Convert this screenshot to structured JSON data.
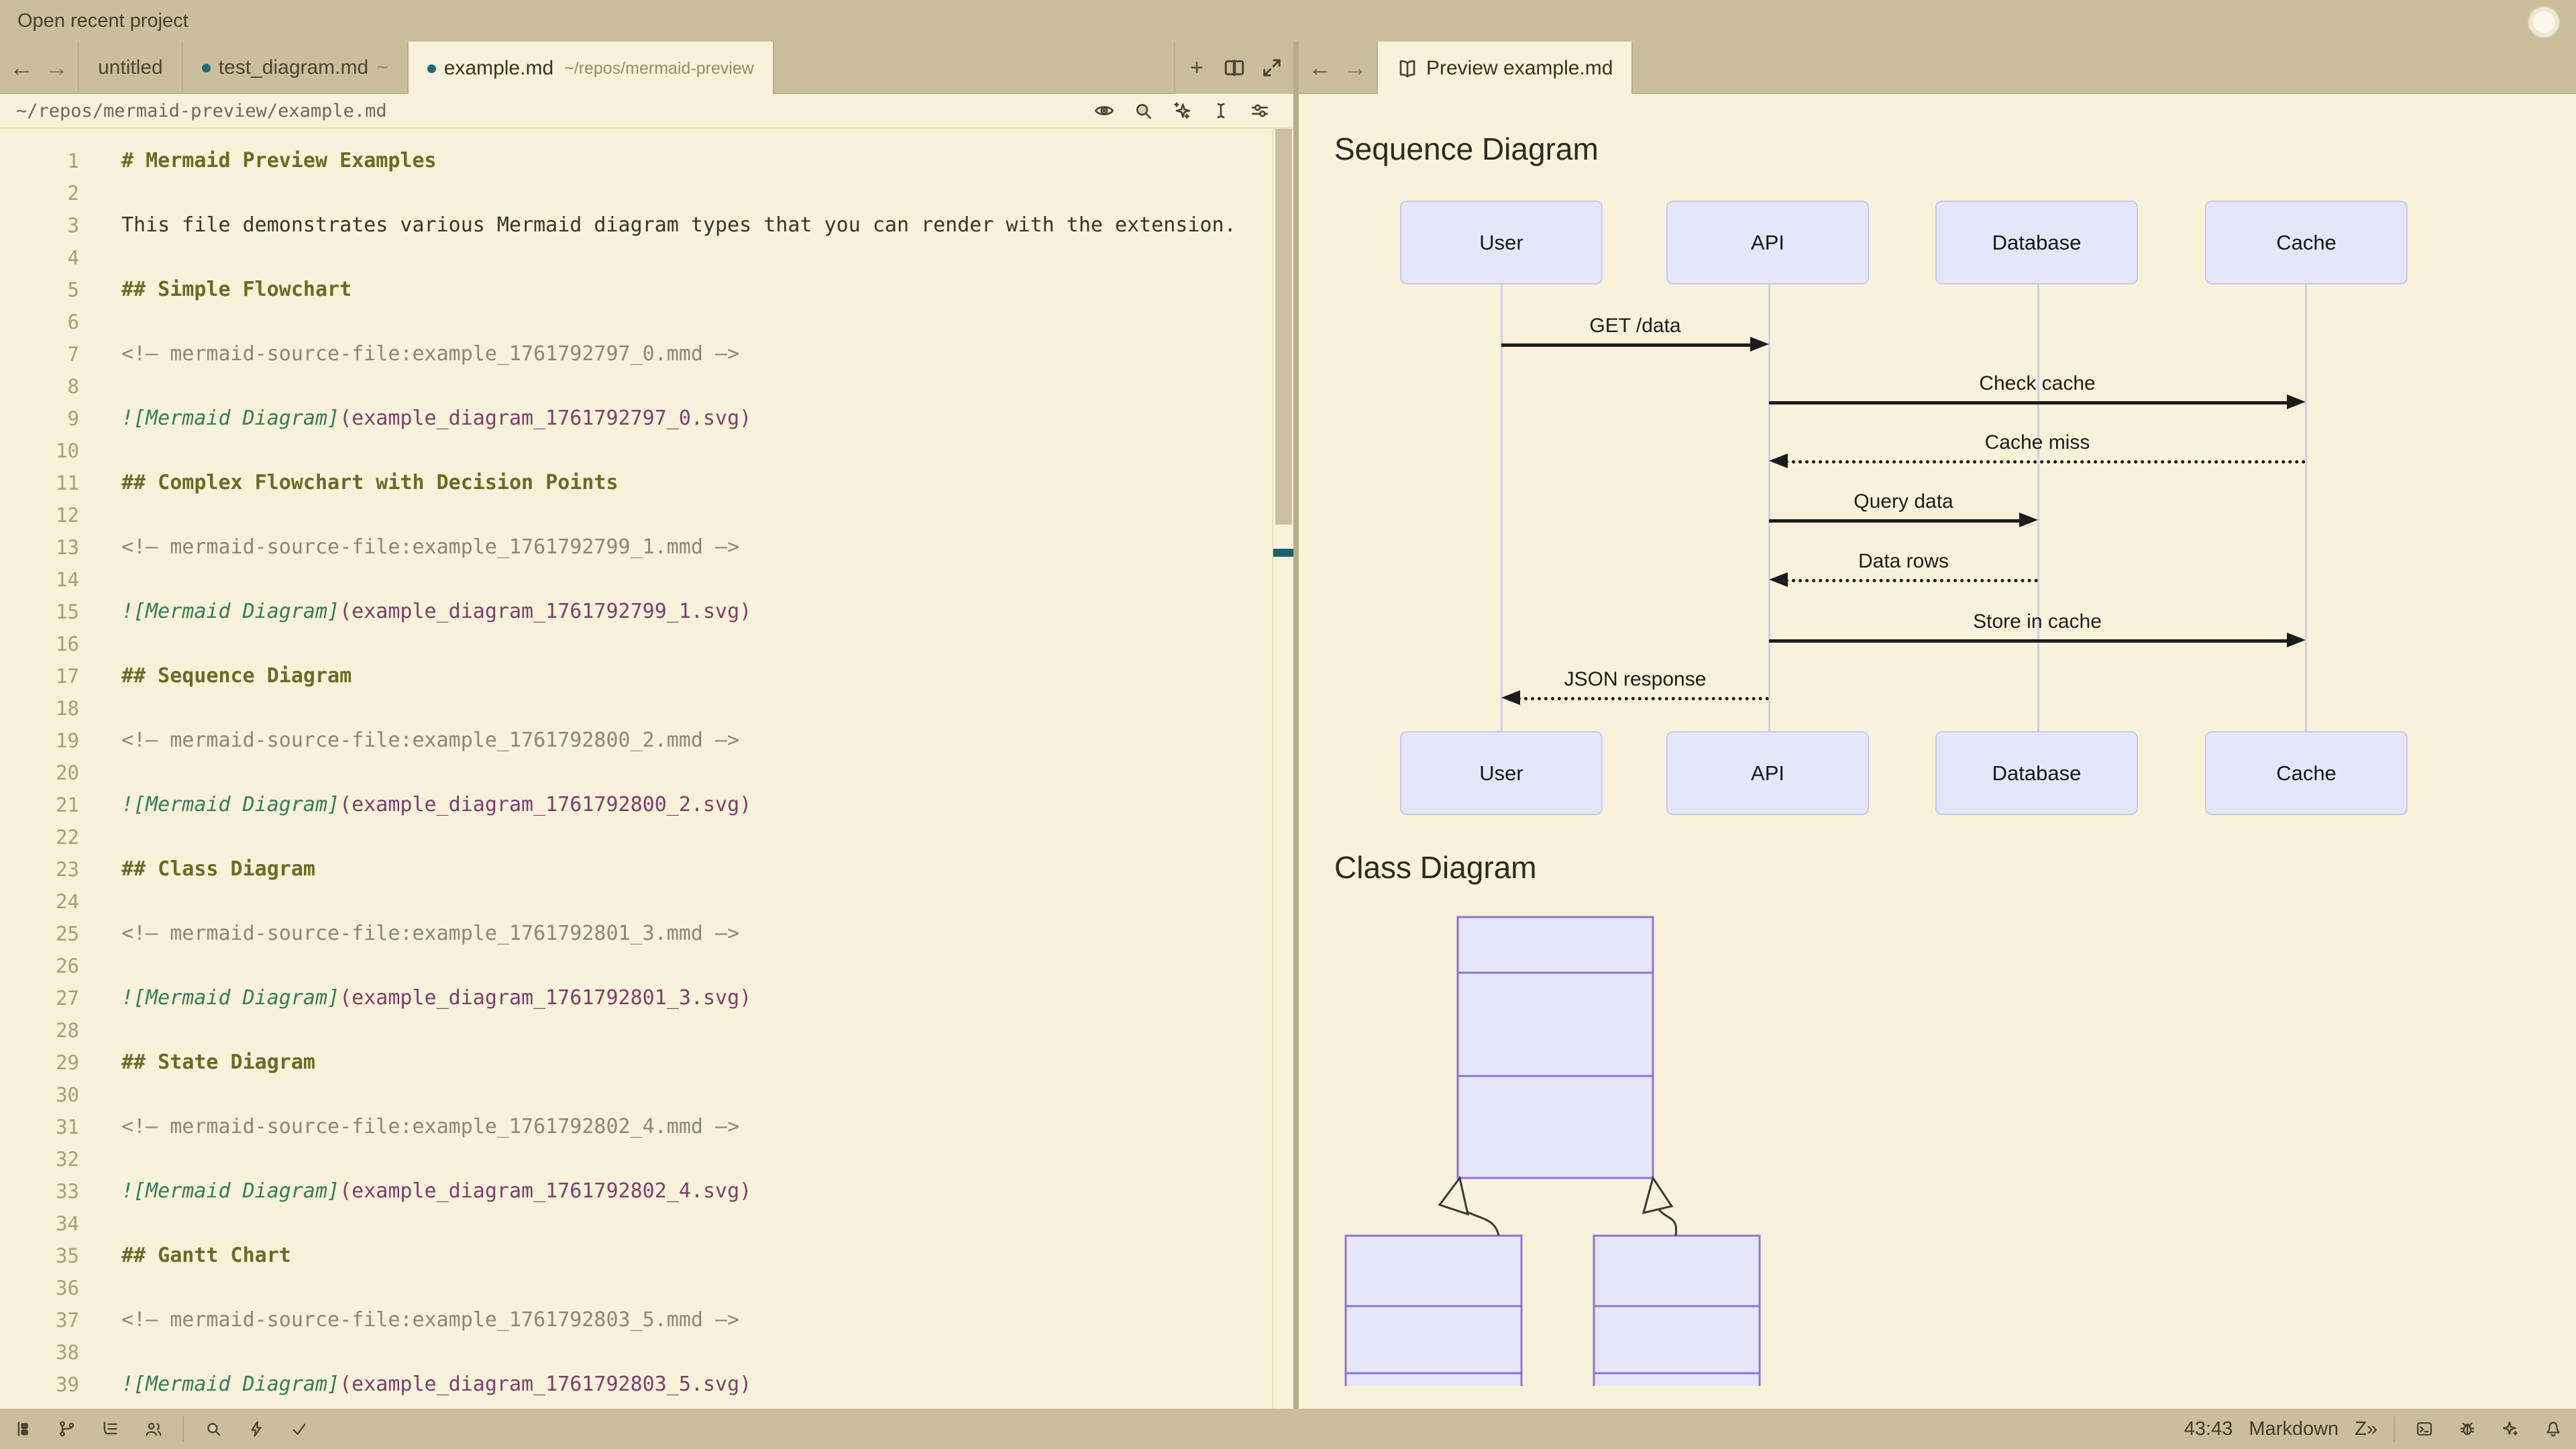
{
  "title_bar": {
    "open_recent_project": "Open recent project"
  },
  "icons": {
    "back_arrow": "←",
    "forward_arrow": "→",
    "new_tab": "+",
    "edit_prediction": "Z»"
  },
  "tab_bar": {
    "left_tabs": [
      {
        "label": "untitled",
        "modified": false,
        "active": false,
        "suffix": "",
        "path": ""
      },
      {
        "label": "test_diagram.md",
        "modified": true,
        "active": false,
        "suffix": "~",
        "path": ""
      },
      {
        "label": "example.md",
        "modified": true,
        "active": true,
        "suffix": "",
        "path": "~/repos/mermaid-preview"
      }
    ],
    "right_tab": {
      "label": "Preview example.md",
      "icon": "book-icon",
      "active": true
    }
  },
  "breadcrumb": {
    "path": "~/repos/mermaid-preview/example.md"
  },
  "toolbar_icons": [
    "preview-eye",
    "search",
    "inline-assist",
    "text-cursor",
    "editor-controls"
  ],
  "editor": {
    "lines": [
      {
        "n": 1,
        "segs": [
          {
            "s": "heading",
            "t": "# Mermaid Preview Examples"
          }
        ]
      },
      {
        "n": 2,
        "segs": []
      },
      {
        "n": 3,
        "segs": [
          {
            "s": "text",
            "t": "This file demonstrates various Mermaid diagram types that you can render with the extension."
          }
        ]
      },
      {
        "n": 4,
        "segs": []
      },
      {
        "n": 5,
        "segs": [
          {
            "s": "heading",
            "t": "## Simple Flowchart"
          }
        ]
      },
      {
        "n": 6,
        "segs": []
      },
      {
        "n": 7,
        "segs": [
          {
            "s": "comment",
            "t": "<!— mermaid-source-file:example_1761792797_0.mmd —>"
          }
        ]
      },
      {
        "n": 8,
        "segs": []
      },
      {
        "n": 9,
        "segs": [
          {
            "s": "imglabel",
            "t": "![Mermaid Diagram]"
          },
          {
            "s": "imgpath",
            "t": "(example_diagram_1761792797_0.svg)"
          }
        ]
      },
      {
        "n": 10,
        "segs": []
      },
      {
        "n": 11,
        "segs": [
          {
            "s": "heading",
            "t": "## Complex Flowchart with Decision Points"
          }
        ]
      },
      {
        "n": 12,
        "segs": []
      },
      {
        "n": 13,
        "segs": [
          {
            "s": "comment",
            "t": "<!— mermaid-source-file:example_1761792799_1.mmd —>"
          }
        ]
      },
      {
        "n": 14,
        "segs": []
      },
      {
        "n": 15,
        "segs": [
          {
            "s": "imglabel",
            "t": "![Mermaid Diagram]"
          },
          {
            "s": "imgpath",
            "t": "(example_diagram_1761792799_1.svg)"
          }
        ]
      },
      {
        "n": 16,
        "segs": []
      },
      {
        "n": 17,
        "segs": [
          {
            "s": "heading",
            "t": "## Sequence Diagram"
          }
        ]
      },
      {
        "n": 18,
        "segs": []
      },
      {
        "n": 19,
        "segs": [
          {
            "s": "comment",
            "t": "<!— mermaid-source-file:example_1761792800_2.mmd —>"
          }
        ]
      },
      {
        "n": 20,
        "segs": []
      },
      {
        "n": 21,
        "segs": [
          {
            "s": "imglabel",
            "t": "![Mermaid Diagram]"
          },
          {
            "s": "imgpath",
            "t": "(example_diagram_1761792800_2.svg)"
          }
        ]
      },
      {
        "n": 22,
        "segs": []
      },
      {
        "n": 23,
        "segs": [
          {
            "s": "heading",
            "t": "## Class Diagram"
          }
        ]
      },
      {
        "n": 24,
        "segs": []
      },
      {
        "n": 25,
        "segs": [
          {
            "s": "comment",
            "t": "<!— mermaid-source-file:example_1761792801_3.mmd —>"
          }
        ]
      },
      {
        "n": 26,
        "segs": []
      },
      {
        "n": 27,
        "segs": [
          {
            "s": "imglabel",
            "t": "![Mermaid Diagram]"
          },
          {
            "s": "imgpath",
            "t": "(example_diagram_1761792801_3.svg)"
          }
        ]
      },
      {
        "n": 28,
        "segs": []
      },
      {
        "n": 29,
        "segs": [
          {
            "s": "heading",
            "t": "## State Diagram"
          }
        ]
      },
      {
        "n": 30,
        "segs": []
      },
      {
        "n": 31,
        "segs": [
          {
            "s": "comment",
            "t": "<!— mermaid-source-file:example_1761792802_4.mmd —>"
          }
        ]
      },
      {
        "n": 32,
        "segs": []
      },
      {
        "n": 33,
        "segs": [
          {
            "s": "imglabel",
            "t": "![Mermaid Diagram]"
          },
          {
            "s": "imgpath",
            "t": "(example_diagram_1761792802_4.svg)"
          }
        ]
      },
      {
        "n": 34,
        "segs": []
      },
      {
        "n": 35,
        "segs": [
          {
            "s": "heading",
            "t": "## Gantt Chart"
          }
        ]
      },
      {
        "n": 36,
        "segs": []
      },
      {
        "n": 37,
        "segs": [
          {
            "s": "comment",
            "t": "<!— mermaid-source-file:example_1761792803_5.mmd —>"
          }
        ]
      },
      {
        "n": 38,
        "segs": []
      },
      {
        "n": 39,
        "segs": [
          {
            "s": "imglabel",
            "t": "![Mermaid Diagram]"
          },
          {
            "s": "imgpath",
            "t": "(example_diagram_1761792803_5.svg)"
          }
        ]
      }
    ]
  },
  "preview": {
    "sequence_heading": "Sequence Diagram",
    "class_heading": "Class Diagram",
    "sequence": {
      "actors": [
        "User",
        "API",
        "Database",
        "Cache"
      ],
      "messages": [
        {
          "label": "GET /data",
          "from": 0,
          "to": 1,
          "dashed": false
        },
        {
          "label": "Check cache",
          "from": 1,
          "to": 3,
          "dashed": false
        },
        {
          "label": "Cache miss",
          "from": 3,
          "to": 1,
          "dashed": true
        },
        {
          "label": "Query data",
          "from": 1,
          "to": 2,
          "dashed": false
        },
        {
          "label": "Data rows",
          "from": 2,
          "to": 1,
          "dashed": true
        },
        {
          "label": "Store in cache",
          "from": 1,
          "to": 3,
          "dashed": false
        },
        {
          "label": "JSON response",
          "from": 1,
          "to": 0,
          "dashed": true
        }
      ]
    }
  },
  "status_bar": {
    "left_icons": [
      "project-panel",
      "git-branch",
      "outline",
      "collab",
      "search",
      "tasks",
      "diagnostics-ok"
    ],
    "cursor_position": "43:43",
    "language": "Markdown",
    "right_icons": [
      "terminal",
      "debug",
      "assistant",
      "notifications"
    ]
  },
  "colors": {
    "chrome_tan": "#CBBE9C",
    "surface_cream": "#F7F2D9",
    "modified_dot_teal": "#1D6B77",
    "actor_fill": "#E6E6FB",
    "actor_border": "#C9C9F0",
    "class_border": "#8F74D6",
    "scroll_marker_teal": "#1F606E"
  }
}
